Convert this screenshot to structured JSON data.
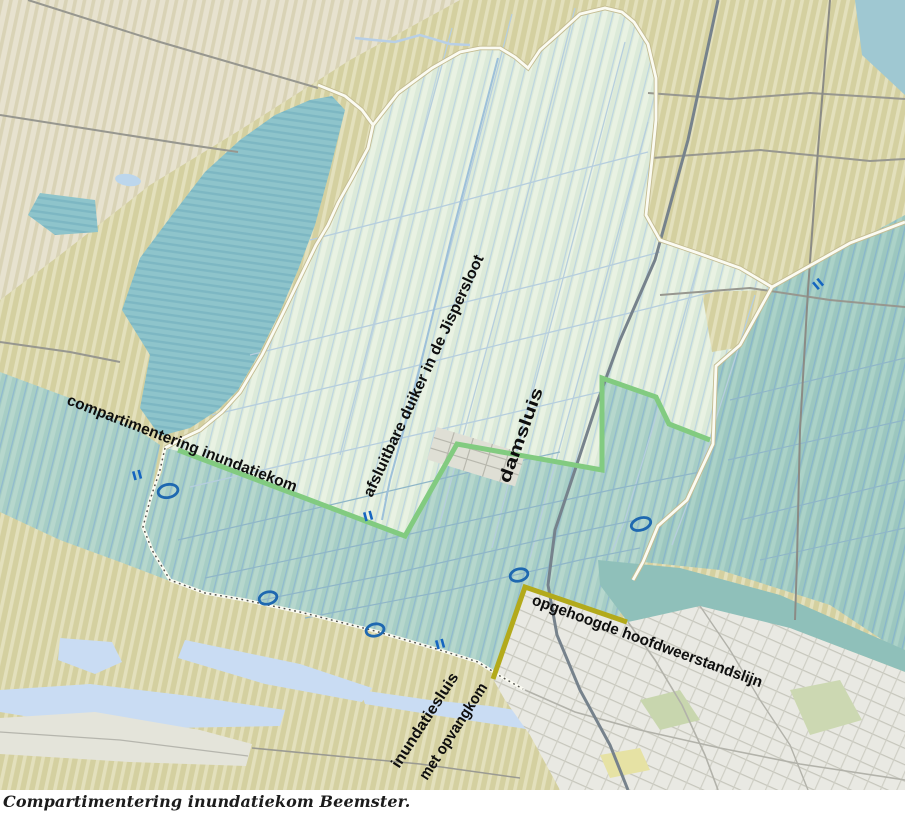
{
  "caption": "Compartimentering inundatiekom Beemster.",
  "map": {
    "labels": {
      "compartimentering": "compartimentering inundatiekom",
      "duiker": "afsluitbare duiker in de Jispersloot",
      "damsluis": "damsluis",
      "hoofdweerstandslijn": "opgehoogde hoofdweerstandslijn",
      "inundatiesluis_line1": "inundatiesluis",
      "inundatiesluis_line2": "met opvangkom"
    },
    "colors": {
      "compartment_line": "#82cb80",
      "raised_line": "#b3aa1b",
      "marker_blue": "#1e68b0",
      "polder_fill": "#dcead9",
      "inundation_fill": "#a7cec5",
      "wetland_fill": "#8ec4cb",
      "fields_fill": "#d4d0a0",
      "urban_fill": "#e9e9e3",
      "water_fill": "#c9dcf3"
    },
    "icons": {
      "sluice_marker": "ellipse-outline",
      "culvert_marker": "double-bar"
    }
  }
}
